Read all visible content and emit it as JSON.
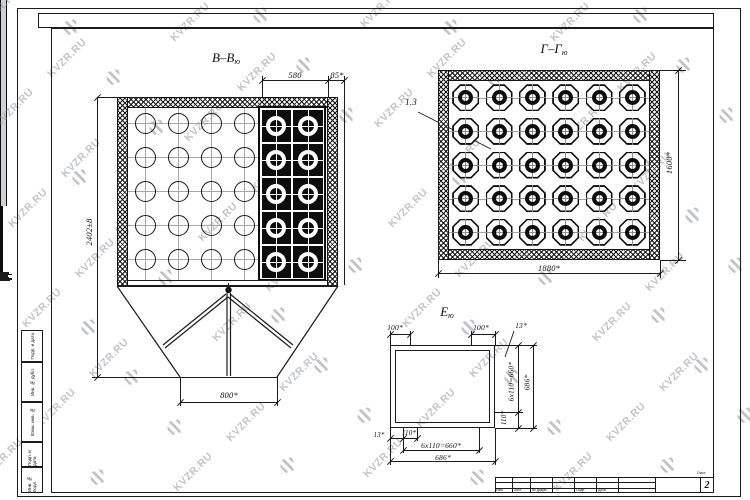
{
  "watermark": {
    "text": "KVZR.RU"
  },
  "views": {
    "bb": {
      "title": "В–В",
      "subscript": "ю",
      "dim_top_main": "580",
      "dim_top_edge": "85*",
      "dim_height": "2402±8",
      "dim_outlet": "800*",
      "open_grid": {
        "rows": 5,
        "cols": 4
      },
      "tube_grid": {
        "rows": 5,
        "cols": 2
      }
    },
    "gg": {
      "title": "Г–Г",
      "subscript": "ю",
      "callout": "1.3",
      "dim_height": "1600*",
      "dim_width": "1880*",
      "grid": {
        "rows": 5,
        "cols": 6
      }
    },
    "e": {
      "title": "Е",
      "subscript": "ю",
      "dim_left_pitch": "100*",
      "dim_right_pitch": "100*",
      "dim_edge_top": "13*",
      "dim_side_pitch": "6x110=660*",
      "dim_side_total": "686*",
      "dim_side_last": "110*",
      "dim_bottom_edge": "13*",
      "dim_bottom_first": "110*",
      "dim_bottom_pitch": "6x110=660*",
      "dim_bottom_total": "686*"
    }
  },
  "frame": {
    "side_stamp_labels": [
      "Подп. и дата",
      "Инв. № дубл.",
      "Взам. инв. №",
      "Подп. и дата",
      "Инв. № подл."
    ],
    "title_block": {
      "sheet_label": "Лист",
      "sheet_number": "2",
      "columns": [
        "Изм.",
        "Лист",
        "№ докум.",
        "Подп.",
        "Дата"
      ]
    }
  }
}
